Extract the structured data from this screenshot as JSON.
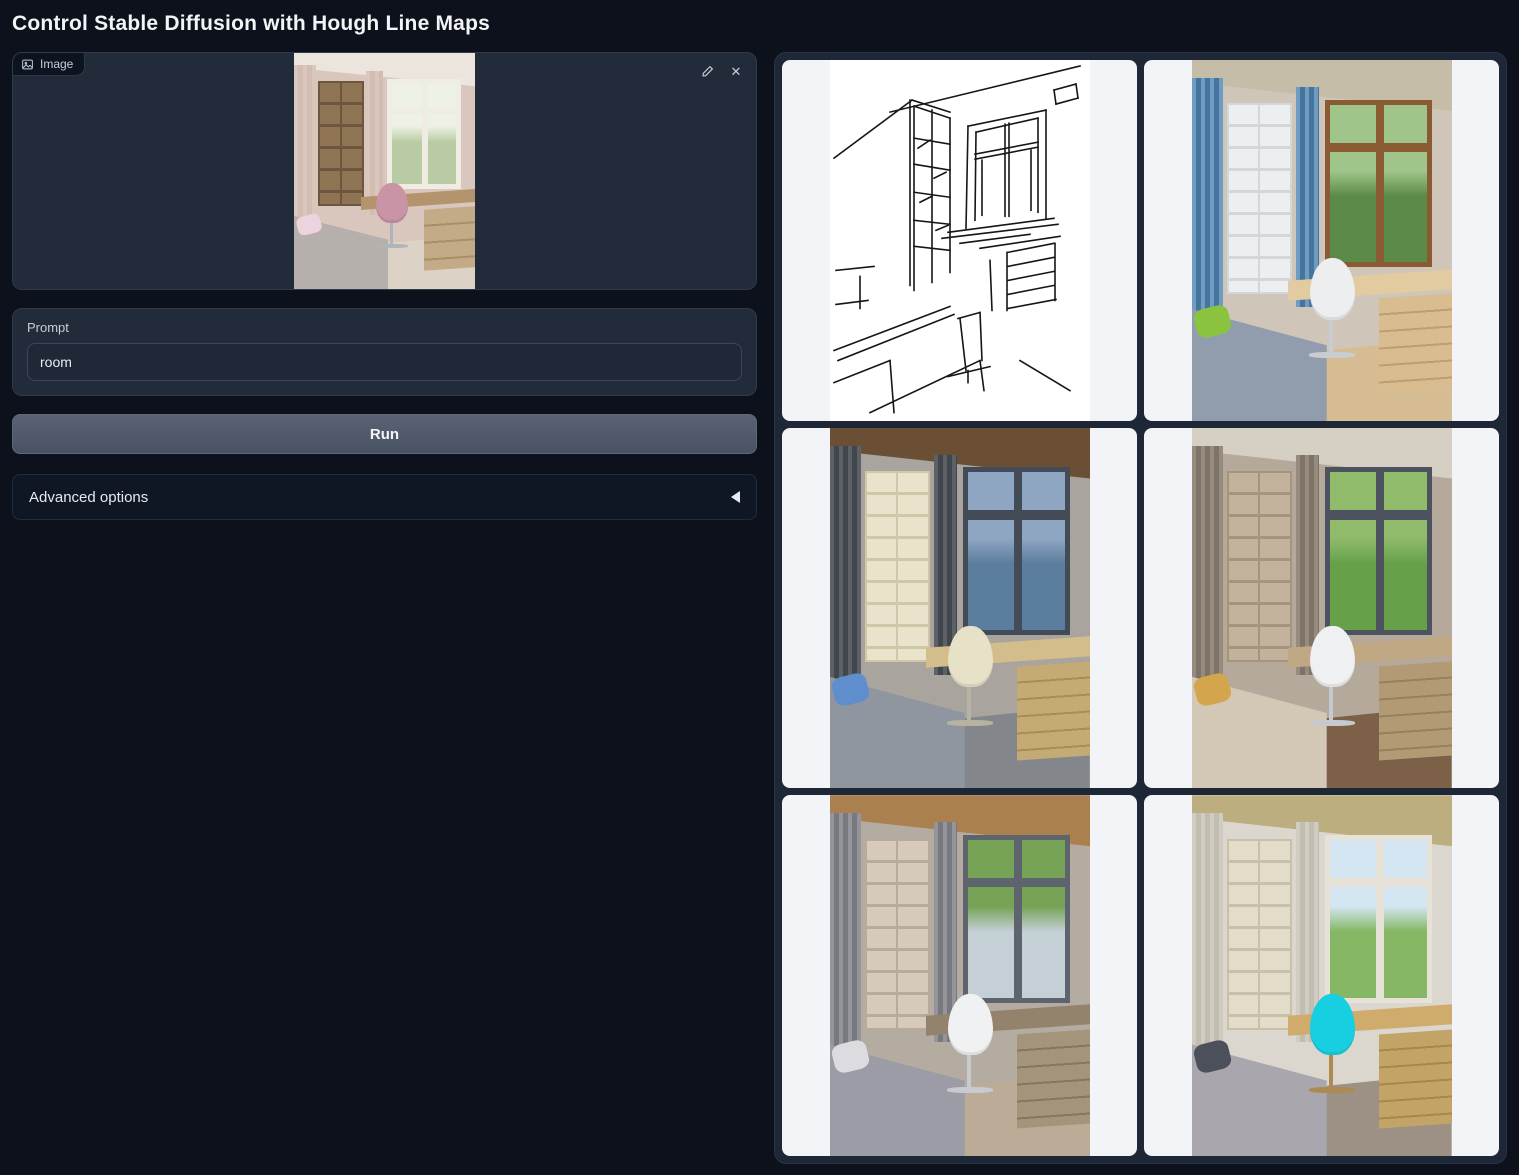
{
  "app": {
    "title": "Control Stable Diffusion with Hough Line Maps"
  },
  "theme": {
    "page_bg": "#0c111c",
    "panel_bg": "#222b39",
    "panel_border": "#2f3a4a",
    "input_bg": "#1f2836",
    "input_border": "#3a465c",
    "button_bg_top": "#5a6375",
    "button_bg_bottom": "#495264",
    "button_border": "#5f6879",
    "accordion_bg": "#101724",
    "accordion_border": "#222c3c",
    "gallery_bg": "#1d2736",
    "gallery_border": "#28334a",
    "card_bg": "#f2f4f7",
    "text_primary": "#f3f4f6",
    "text_secondary": "#c7cedb",
    "linework": "#161616"
  },
  "image_input": {
    "label": "Image",
    "clear_glyph": "✕",
    "icons": {
      "badge": "image-icon",
      "edit": "pencil-icon",
      "clear": "x-icon"
    },
    "palette": {
      "wall": "#d9c6bd",
      "ceiling": "#ece5dd",
      "floor": "#dcd3c6",
      "curtain": "#d9c6bd",
      "curtain2": "#d2bdb3",
      "shelfbg": "#8f7454",
      "shelfline": "#6d5640",
      "sky1": "#eef2e4",
      "sky2": "#b9cba4",
      "frame": "#efece4",
      "desk": "#b3946c",
      "drawer": "#c3ab88",
      "drawerline": "#a98e68",
      "chair": "#c995a6",
      "chairleg": "#b0b4ba",
      "bed": "#b5b0ab",
      "pillow": "#ecd3de"
    }
  },
  "prompt": {
    "label": "Prompt",
    "value": "room"
  },
  "run_button": {
    "label": "Run"
  },
  "advanced_options": {
    "label": "Advanced options",
    "collapse_icon": "triangle-left-icon"
  },
  "gallery": {
    "items": [
      {
        "name": "hough-line-map",
        "kind": "linemap"
      },
      {
        "name": "generated-room-1",
        "kind": "scene",
        "palette": {
          "wall": "#cfc5b8",
          "ceiling": "#c6bda9",
          "floor": "#d6bc93",
          "curtain": "#6f9dc2",
          "curtain2": "#47749c",
          "shelfbg": "#eceef0",
          "shelfline": "#d3d7dc",
          "sky1": "#9fc58a",
          "sky2": "#5c8a48",
          "frame": "#8a5a33",
          "desk": "#e2cba0",
          "drawer": "#d9bd90",
          "drawerline": "#bd9f70",
          "chair": "#eceef0",
          "chairleg": "#c9ccd1",
          "bed": "#919dad",
          "pillow": "#8ac43e"
        }
      },
      {
        "name": "generated-room-2",
        "kind": "scene",
        "palette": {
          "wall": "#a9a59e",
          "ceiling": "#6b4f35",
          "floor": "#83878c",
          "curtain": "#5c6168",
          "curtain2": "#41464d",
          "shelfbg": "#e9e3cb",
          "shelfline": "#cfc7a8",
          "sky1": "#8fa6c2",
          "sky2": "#5b7d9e",
          "frame": "#434b57",
          "desk": "#d3bd8a",
          "drawer": "#c4aa74",
          "drawerline": "#a88d58",
          "chair": "#e7e1c7",
          "chairleg": "#b7b3a2",
          "bed": "#8f96a0",
          "pillow": "#5e8ecb"
        }
      },
      {
        "name": "generated-room-3",
        "kind": "scene",
        "palette": {
          "wall": "#b4a99b",
          "ceiling": "#d6cfc4",
          "floor": "#7c6047",
          "curtain": "#968b7d",
          "curtain2": "#7d7366",
          "shelfbg": "#c3b29c",
          "shelfline": "#a6947c",
          "sky1": "#8fbb6a",
          "sky2": "#66a14a",
          "frame": "#4c525e",
          "desk": "#c0a884",
          "drawer": "#b29a74",
          "drawerline": "#97805c",
          "chair": "#eef0f1",
          "chairleg": "#c6c9cd",
          "bed": "#d3c8b6",
          "pillow": "#d3a64e"
        }
      },
      {
        "name": "generated-room-4",
        "kind": "scene",
        "palette": {
          "wall": "#b5aca1",
          "ceiling": "#aa804f",
          "floor": "#bcac97",
          "curtain": "#93959a",
          "curtain2": "#77797e",
          "shelfbg": "#d5cabb",
          "shelfline": "#b8ab97",
          "sky1": "#76a355",
          "sky2": "#c4cfd6",
          "frame": "#5d646e",
          "desk": "#94836c",
          "drawer": "#a4947c",
          "drawerline": "#877659",
          "chair": "#eff1f2",
          "chairleg": "#c7cace",
          "bed": "#9c9ca6",
          "pillow": "#dcdce0"
        }
      },
      {
        "name": "generated-room-5",
        "kind": "scene",
        "palette": {
          "wall": "#dbd7cf",
          "ceiling": "#bcae7e",
          "floor": "#9c9184",
          "curtain": "#d0ccc2",
          "curtain2": "#c2bdb1",
          "shelfbg": "#e3dcc9",
          "shelfline": "#c8c0a8",
          "sky1": "#d3e6f2",
          "sky2": "#85b764",
          "frame": "#e6e2d8",
          "desk": "#cfab6c",
          "drawer": "#c2a468",
          "drawerline": "#a68848",
          "chair": "#18cfe2",
          "chairleg": "#ad8a52",
          "bed": "#aaa6ae",
          "pillow": "#4c505a"
        }
      }
    ]
  }
}
